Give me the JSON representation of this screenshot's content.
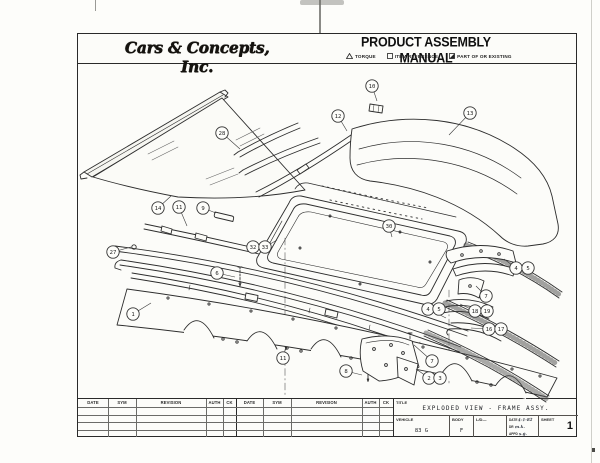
{
  "header": {
    "logo_text": "Cars & Concepts, Inc.",
    "manual_title": "PRODUCT ASSEMBLY MANUAL",
    "legend": [
      {
        "icon": "triangle-icon",
        "label": "TORQUE"
      },
      {
        "icon": "square-icon",
        "label": "ITEM REFERENCE"
      },
      {
        "icon": "half-filled-square-icon",
        "label": "PART OF OR EXISTING"
      }
    ]
  },
  "drawing": {
    "balloons": [
      {
        "n": "10",
        "x": 372,
        "y": 86,
        "tx": 377,
        "ty": 101
      },
      {
        "n": "12",
        "x": 338,
        "y": 116,
        "tx": 347,
        "ty": 131
      },
      {
        "n": "13",
        "x": 470,
        "y": 113,
        "tx": 449,
        "ty": 135
      },
      {
        "n": "28",
        "x": 222,
        "y": 133,
        "tx": 240,
        "ty": 149
      },
      {
        "n": "14",
        "x": 158,
        "y": 208,
        "tx": 171,
        "ty": 196
      },
      {
        "n": "11",
        "x": 179,
        "y": 207,
        "tx": 187,
        "ty": 226
      },
      {
        "n": "9",
        "x": 203,
        "y": 208,
        "tx": 216,
        "ty": 213
      },
      {
        "n": "27",
        "x": 113,
        "y": 252,
        "tx": 131,
        "ty": 247
      },
      {
        "n": "32",
        "x": 253,
        "y": 247
      },
      {
        "n": "33",
        "x": 265,
        "y": 247,
        "tx": 277,
        "ty": 240
      },
      {
        "n": "30",
        "x": 389,
        "y": 226,
        "tx": 392,
        "ty": 237
      },
      {
        "n": "6",
        "x": 217,
        "y": 273,
        "tx": 235,
        "ty": 277
      },
      {
        "n": "1",
        "x": 133,
        "y": 314,
        "tx": 151,
        "ty": 303
      },
      {
        "n": "4",
        "x": 516,
        "y": 268,
        "tx": 504,
        "ty": 259
      },
      {
        "n": "5",
        "x": 528,
        "y": 268
      },
      {
        "n": "7",
        "x": 486,
        "y": 296,
        "tx": 476,
        "ty": 286
      },
      {
        "n": "18",
        "x": 475,
        "y": 311,
        "tx": 460,
        "ty": 304
      },
      {
        "n": "19",
        "x": 487,
        "y": 311
      },
      {
        "n": "16",
        "x": 489,
        "y": 329,
        "tx": 471,
        "ty": 328
      },
      {
        "n": "17",
        "x": 501,
        "y": 329
      },
      {
        "n": "4",
        "x": 428,
        "y": 309,
        "tx": 446,
        "ty": 318
      },
      {
        "n": "5",
        "x": 439,
        "y": 309
      },
      {
        "n": "7",
        "x": 432,
        "y": 361,
        "tx": 414,
        "ty": 345
      },
      {
        "n": "2",
        "x": 429,
        "y": 378,
        "tx": 416,
        "ty": 369
      },
      {
        "n": "3",
        "x": 440,
        "y": 378
      },
      {
        "n": "8",
        "x": 346,
        "y": 371,
        "tx": 362,
        "ty": 375
      },
      {
        "n": "11",
        "x": 283,
        "y": 358,
        "tx": 286,
        "ty": 347
      }
    ]
  },
  "title_block": {
    "rev_headers": [
      "DATE",
      "SYM",
      "REVISION",
      "AUTH",
      "CK"
    ],
    "title_label": "TITLE",
    "title_value": "EXPLODED VIEW - FRAME ASSY.",
    "vehicle_label": "VEHICLE",
    "vehicle_value": "83 G",
    "body_label": "BODY",
    "body_value": "F",
    "ld_label": "L/D—",
    "date_label": "DATE",
    "date_value": "4-1-82",
    "dr_label": "DR",
    "dr_value": "m.k.",
    "appd_label": "APPD",
    "appd_value": "s.g.",
    "sheet_label": "SHEET",
    "sheet_value": "1"
  }
}
